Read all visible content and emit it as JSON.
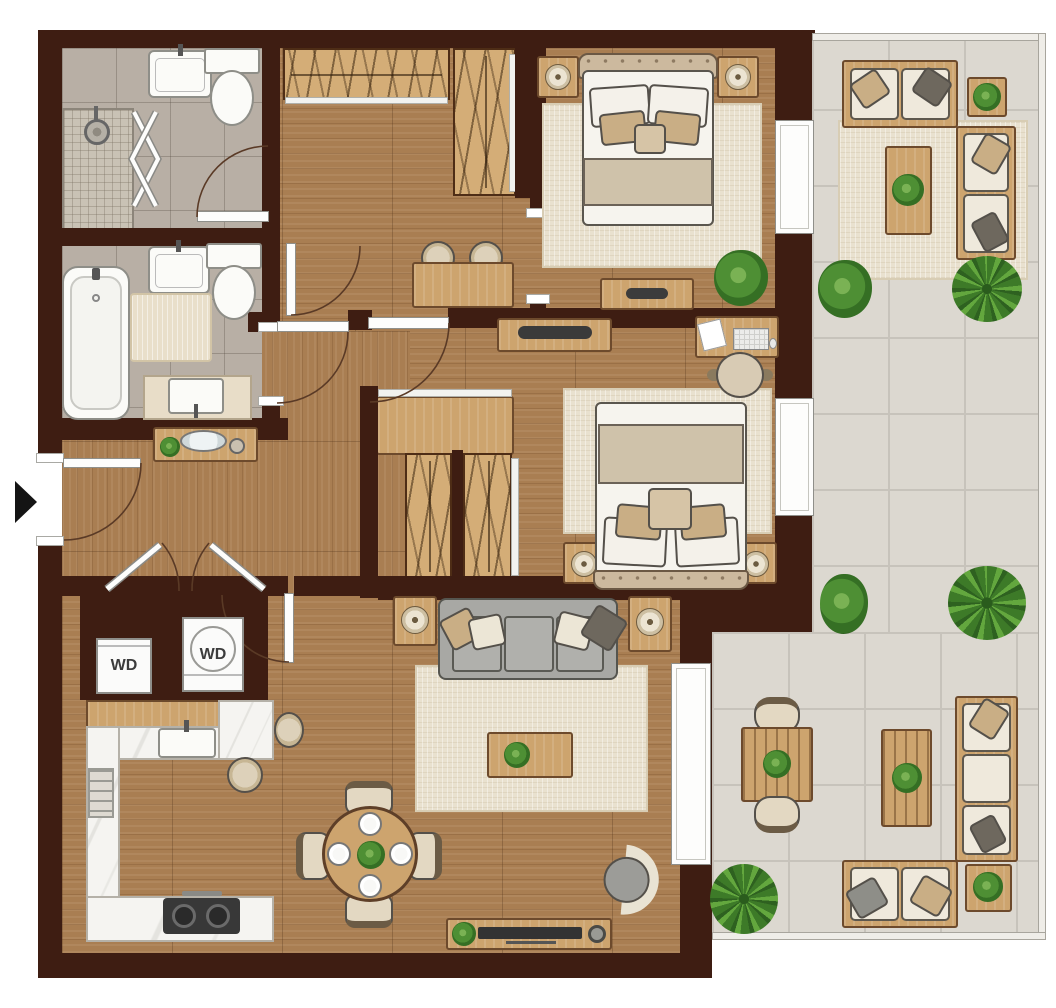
{
  "labels": {
    "washer_dryer_left": "WD",
    "washer_dryer_right": "WD"
  },
  "colors": {
    "wall": "#3e1d12",
    "floor": "#a97e52",
    "bath-tile": "#b8afa5",
    "shower-tile": "#c9c2b5",
    "balcony-tile": "#dcd8d0",
    "grout": "#c7c3bb",
    "marble": "#f5f4f1",
    "furniture-wood": "#cda46e",
    "closet-wood": "#d4ad77",
    "rug": "#e9e1cf",
    "fixture-white": "#fbfbf8",
    "cushion-cream": "#efe9dc",
    "pillow-beige": "#c9ae85",
    "pillow-dark": "#6e685e",
    "sofa-gray": "#a3a3a0",
    "plant-green": "#4e8f34",
    "accent-dark": "#3a3a3a"
  }
}
